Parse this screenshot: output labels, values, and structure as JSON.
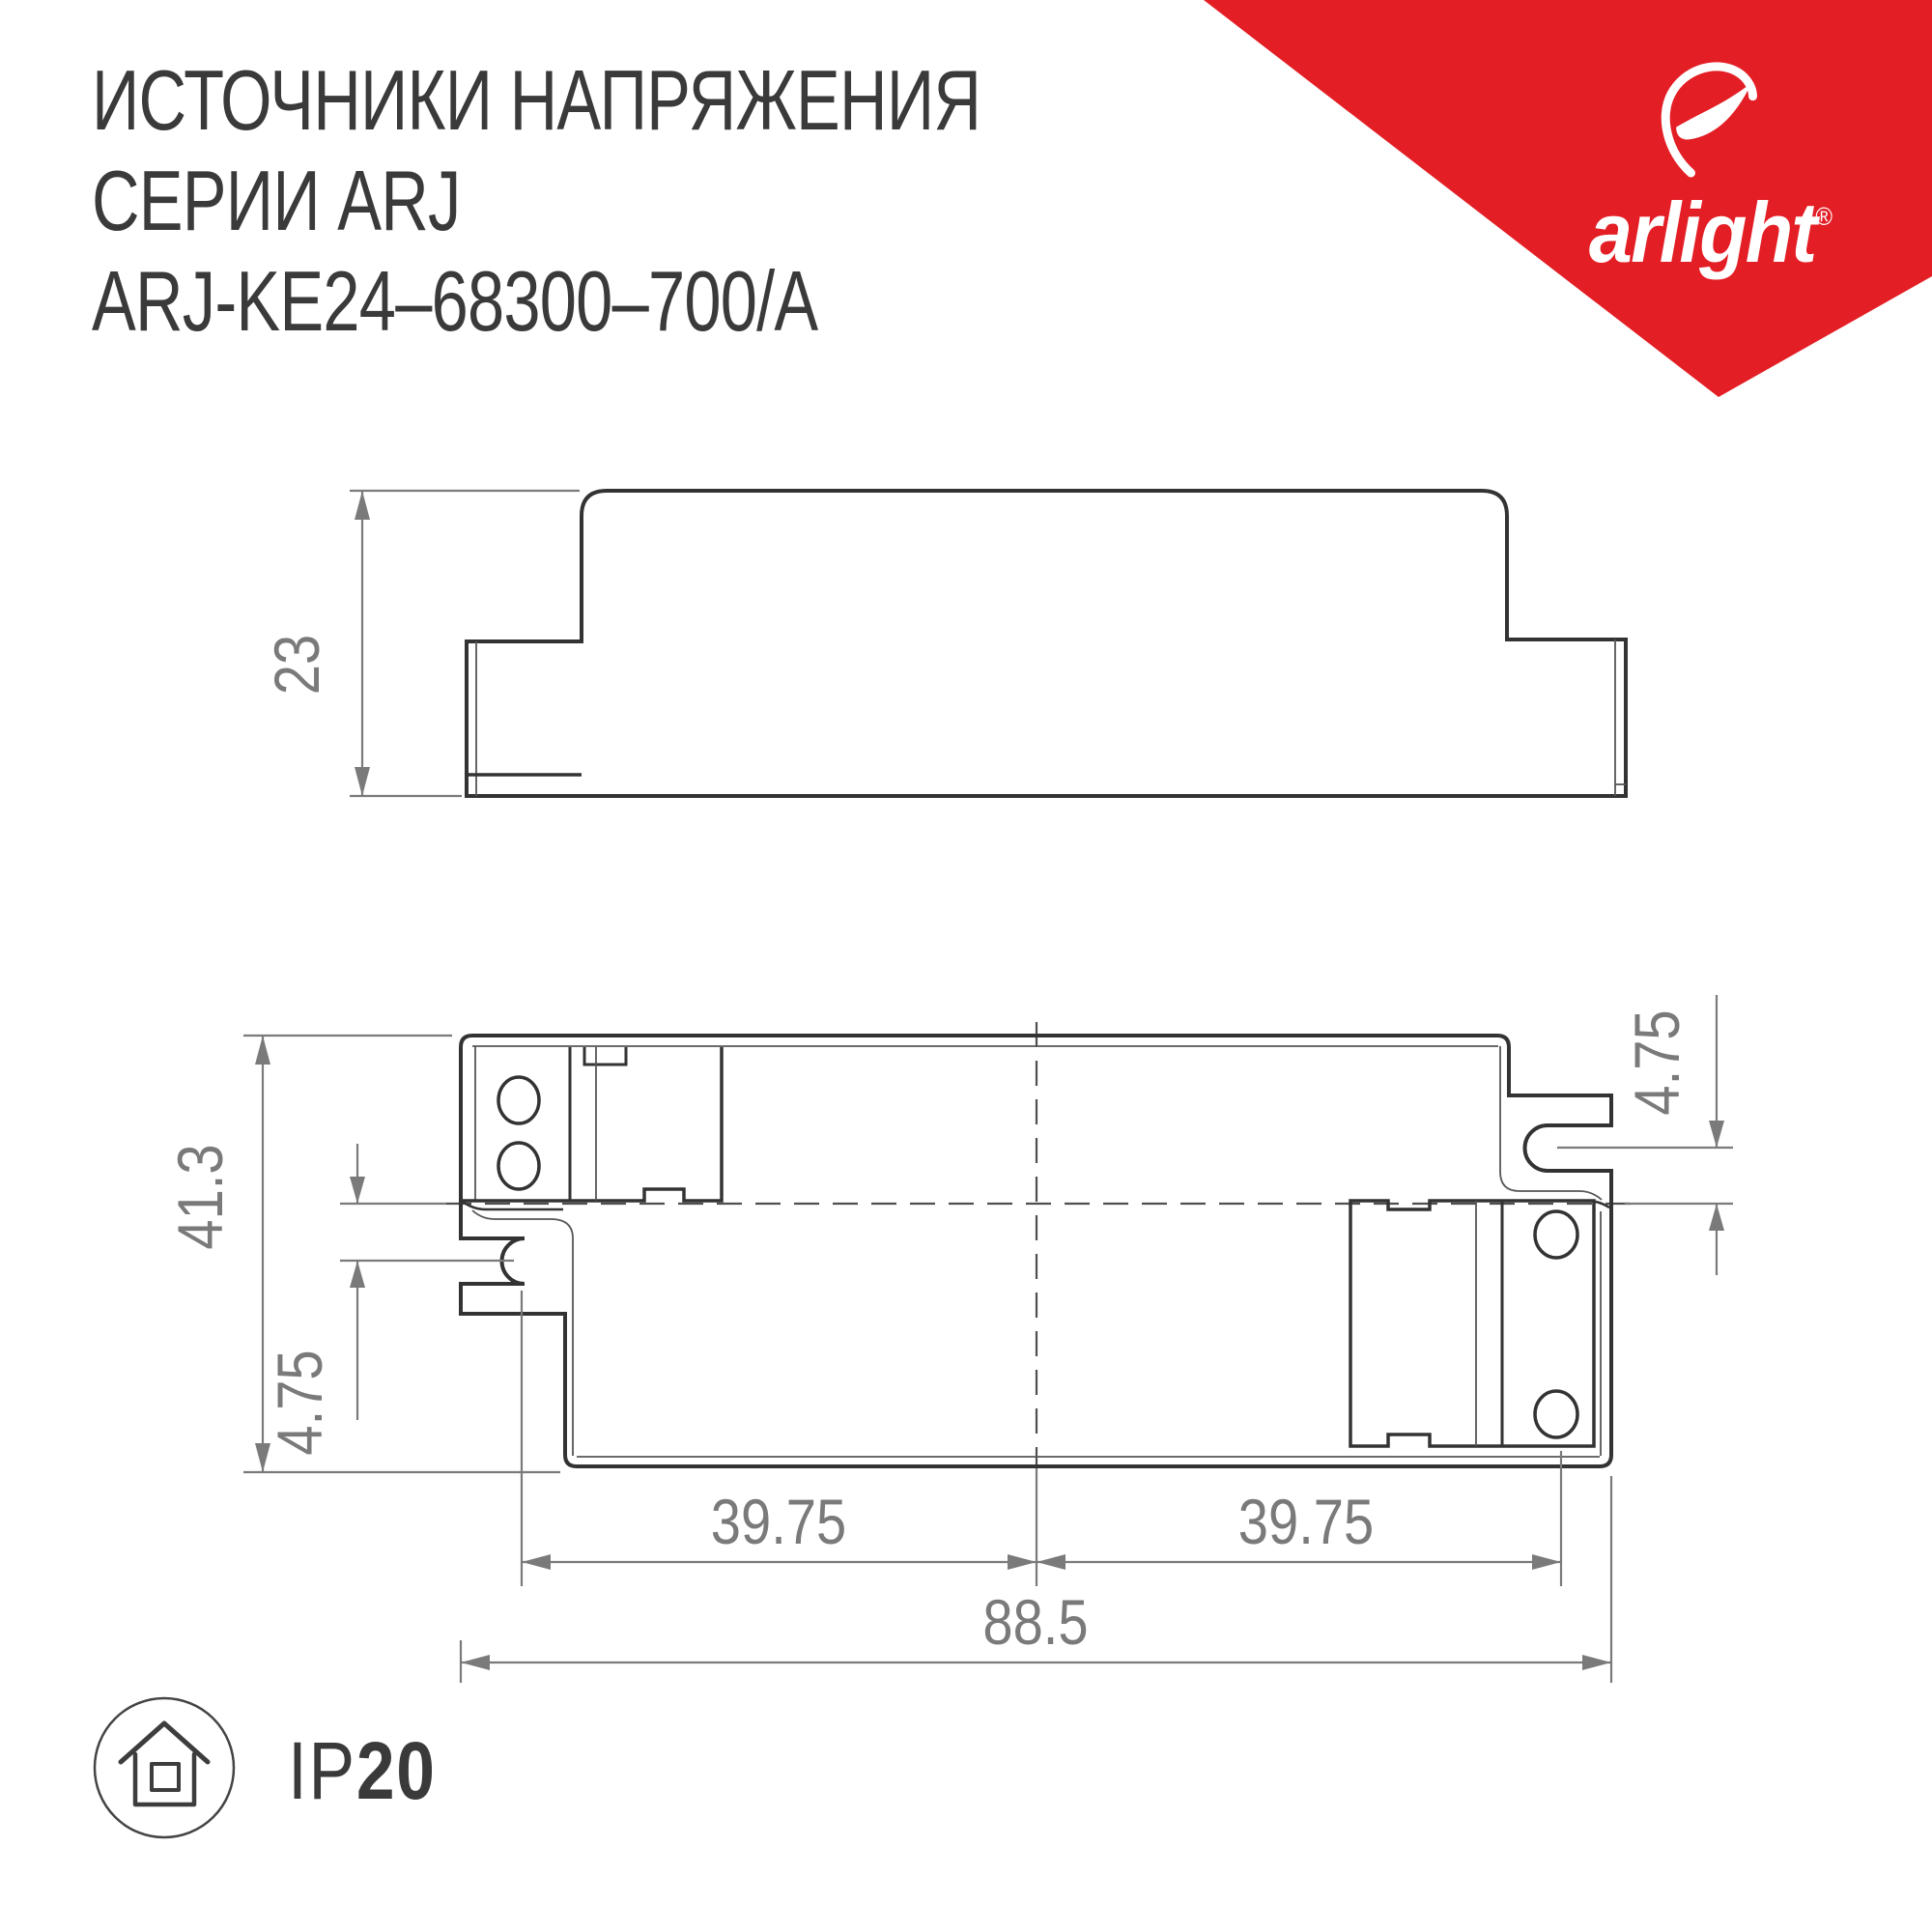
{
  "header": {
    "line1": "ИСТОЧНИКИ НАПРЯЖЕНИЯ",
    "line2": "СЕРИИ ARJ",
    "line3": "ARJ-KE24–68300–700/A"
  },
  "brand": {
    "name": "arlight",
    "registered": "®",
    "triangle_color": "#e31e25"
  },
  "drawings": {
    "side_view": {
      "height": "23"
    },
    "bottom_view": {
      "overall_height": "41.3",
      "overall_width": "88.5",
      "slot_offset_left": "4.75",
      "slot_offset_right": "4.75",
      "slot_spacing_left": "39.75",
      "slot_spacing_right": "39.75"
    }
  },
  "footer": {
    "ip_prefix": "IP",
    "ip_value": "20"
  },
  "colors": {
    "outline": "#333333",
    "thin_line": "#565656",
    "dimension_gray": "#7a7a7a",
    "title_text": "#3a3a3a",
    "brand_red": "#e31e25"
  }
}
